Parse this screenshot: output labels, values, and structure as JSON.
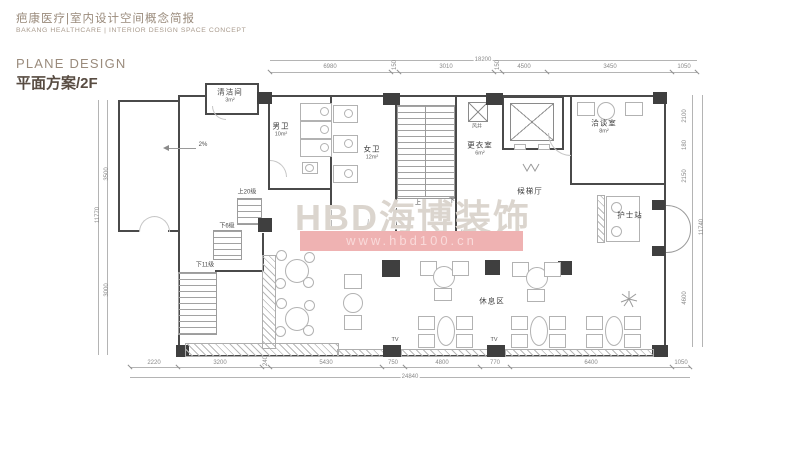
{
  "header": {
    "title_cn": "疤康医疗|室内设计空间概念简报",
    "title_en": "BAKANG HEALTHCARE | INTERIOR DESIGN SPACE CONCEPT"
  },
  "section": {
    "en": "PLANE DESIGN",
    "cn": "平面方案/2F"
  },
  "watermark": {
    "brand": "HBD海博装饰",
    "url": "www.hbd100.cn",
    "band_color": "#efb2b2",
    "brand_color": "#dbd5ce"
  },
  "plan": {
    "rooms": {
      "cleaning": {
        "name": "清洁间",
        "area": "3m²"
      },
      "male_wc": {
        "name": "男卫",
        "area": "10m²"
      },
      "female_wc": {
        "name": "女卫",
        "area": "12m²"
      },
      "changing": {
        "name": "更衣室",
        "area": "6m²"
      },
      "shaft": {
        "name": "风井"
      },
      "lobby": {
        "name": "候梯厅"
      },
      "meeting": {
        "name": "洽谈室",
        "area": "8m²"
      },
      "nurse": {
        "name": "护士站"
      },
      "rest": {
        "name": "休息区"
      }
    },
    "stairs": {
      "up20": "上20级",
      "down6": "下6级",
      "down11": "下11级",
      "up": "上",
      "down": "下"
    },
    "slope": "2%",
    "tv": "TV",
    "dims": {
      "top": {
        "total": "18200",
        "segments": [
          "6980",
          "150",
          "3010",
          "150",
          "4500",
          "3450",
          "1050"
        ]
      },
      "bottom": {
        "total": "24840",
        "segments": [
          "2220",
          "3200",
          "240",
          "5430",
          "750",
          "4800",
          "770",
          "6400",
          "1050"
        ]
      },
      "left": {
        "total": "11770",
        "segments": [
          "3500",
          "3000"
        ]
      },
      "right": {
        "total": "11740",
        "segments": [
          "2100",
          "180",
          "2150",
          "1760",
          "4600"
        ]
      }
    }
  }
}
